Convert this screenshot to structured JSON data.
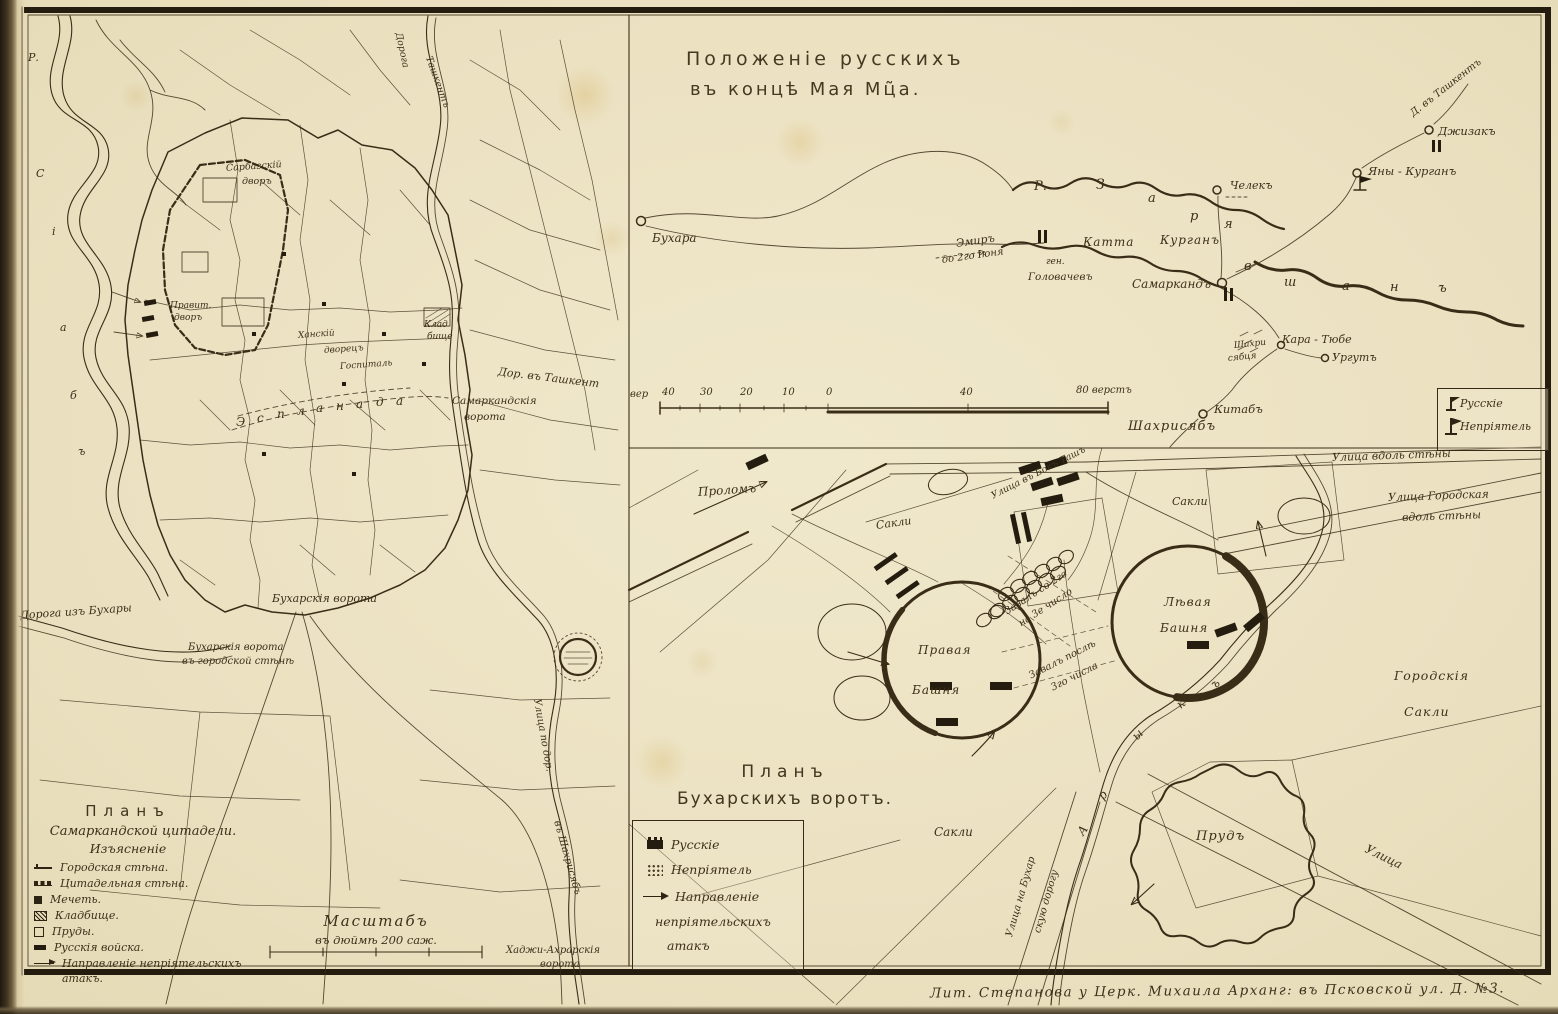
{
  "page": {
    "imprint": "Лит. Степанова   у Церк. Михаила   Арханг: въ Псковской ул. Д. №3."
  },
  "city_plan": {
    "legend": {
      "title": "Планъ",
      "subtitle": "Самаркандской цитадели.",
      "heading": "Изъясненіе",
      "items": [
        {
          "symbol": "city-wall",
          "label": "Городская стѣна."
        },
        {
          "symbol": "citadel-wall",
          "label": "Цитадельная стѣна."
        },
        {
          "symbol": "mosque",
          "label": "Мечеть."
        },
        {
          "symbol": "cemetery",
          "label": "Кладбище."
        },
        {
          "symbol": "pond",
          "label": "Пруды."
        },
        {
          "symbol": "russian-troops",
          "label": "Русскія войска."
        },
        {
          "symbol": "attack-direction",
          "label": "Направленіе непріятельскихъ"
        },
        {
          "symbol": "none",
          "label": "атакъ."
        }
      ]
    },
    "scale": {
      "title": "Масштабъ",
      "subtitle": "въ дюймѣ 200 саж."
    },
    "labels": [
      {
        "t": "Дорога",
        "x": 398,
        "y": 28,
        "r": 78,
        "s": 9.5
      },
      {
        "t": "Ташкентъ",
        "x": 428,
        "y": 52,
        "r": 70,
        "s": 9.5
      },
      {
        "t": "Сарбазскій",
        "x": 226,
        "y": 164,
        "r": -4,
        "s": 9.5
      },
      {
        "t": "дворъ",
        "x": 242,
        "y": 177,
        "s": 9.5
      },
      {
        "t": "Правит.",
        "x": 170,
        "y": 302,
        "s": 9
      },
      {
        "t": "дворъ",
        "x": 174,
        "y": 314,
        "s": 9
      },
      {
        "t": "Ханскій",
        "x": 298,
        "y": 332,
        "r": -4,
        "s": 9
      },
      {
        "t": "дворецъ",
        "x": 324,
        "y": 347,
        "r": -4,
        "s": 9
      },
      {
        "t": "Госпиталь",
        "x": 340,
        "y": 363,
        "r": -4,
        "s": 9
      },
      {
        "t": "Клад",
        "x": 424,
        "y": 321,
        "s": 9
      },
      {
        "t": "бище",
        "x": 427,
        "y": 333,
        "s": 9
      },
      {
        "t": "Дор. въ Ташкент",
        "x": 498,
        "y": 366,
        "r": 7,
        "s": 11
      },
      {
        "t": "Самаркандскія",
        "x": 452,
        "y": 396,
        "s": 10.5
      },
      {
        "t": "ворота",
        "x": 464,
        "y": 412,
        "s": 10.5
      },
      {
        "t": "Бухарскія ворота",
        "x": 272,
        "y": 593,
        "s": 11
      },
      {
        "t": "Бухарскія ворота",
        "x": 188,
        "y": 643,
        "s": 10
      },
      {
        "t": "въ городской стѣнѣ",
        "x": 182,
        "y": 657,
        "s": 10
      },
      {
        "t": "Дорога изъ Бухары",
        "x": 20,
        "y": 610,
        "r": -4,
        "s": 11
      },
      {
        "t": "Улица по дор.",
        "x": 536,
        "y": 694,
        "r": 80,
        "s": 10
      },
      {
        "t": "въ Шахрисябъ",
        "x": 556,
        "y": 816,
        "r": 74,
        "s": 10
      },
      {
        "t": "Хаджи-Ахрарскія",
        "x": 506,
        "y": 946,
        "s": 10
      },
      {
        "t": "ворота",
        "x": 540,
        "y": 960,
        "s": 10
      },
      {
        "t": "Р.",
        "x": 28,
        "y": 52,
        "s": 11
      },
      {
        "t": "С",
        "x": 36,
        "y": 168,
        "s": 11
      },
      {
        "t": "і",
        "x": 52,
        "y": 226,
        "s": 11
      },
      {
        "t": "а",
        "x": 60,
        "y": 322,
        "s": 11
      },
      {
        "t": "б",
        "x": 70,
        "y": 390,
        "s": 11
      },
      {
        "t": "ъ",
        "x": 78,
        "y": 446,
        "s": 11
      },
      {
        "t": "Э",
        "x": 236,
        "y": 416,
        "s": 12
      },
      {
        "t": "с",
        "x": 257,
        "y": 412,
        "s": 12
      },
      {
        "t": "п",
        "x": 277,
        "y": 408,
        "s": 12
      },
      {
        "t": "л",
        "x": 297,
        "y": 405,
        "s": 12
      },
      {
        "t": "а",
        "x": 316,
        "y": 402,
        "s": 12
      },
      {
        "t": "н",
        "x": 336,
        "y": 400,
        "s": 12
      },
      {
        "t": "а",
        "x": 356,
        "y": 398,
        "s": 12
      },
      {
        "t": "д",
        "x": 376,
        "y": 396,
        "s": 12
      },
      {
        "t": "а",
        "x": 396,
        "y": 395,
        "s": 12
      }
    ]
  },
  "overview_map": {
    "title_line1": "Положеніе русскихъ",
    "title_line2": "въ концѣ Мая Мц̃а.",
    "legend": {
      "items": [
        {
          "symbol": "russian-flag",
          "label": "Русскіе"
        },
        {
          "symbol": "enemy-flag",
          "label": "Непріятель"
        }
      ]
    },
    "labels": [
      {
        "t": "Бухара",
        "x": 652,
        "y": 232,
        "s": 12
      },
      {
        "t": "Эмиръ",
        "x": 956,
        "y": 238,
        "r": -8,
        "s": 11
      },
      {
        "t": "до 2го Іюня",
        "x": 942,
        "y": 256,
        "r": -8,
        "s": 10
      },
      {
        "t": "ген.",
        "x": 1046,
        "y": 258,
        "s": 9
      },
      {
        "t": "Головачевъ",
        "x": 1028,
        "y": 272,
        "s": 10.5
      },
      {
        "t": "Катта",
        "x": 1083,
        "y": 236,
        "s": 12,
        "ls": 1
      },
      {
        "t": "Курганъ",
        "x": 1160,
        "y": 234,
        "s": 12,
        "ls": 1
      },
      {
        "t": "Самаркандъ",
        "x": 1132,
        "y": 278,
        "s": 12
      },
      {
        "t": "Челекъ",
        "x": 1230,
        "y": 180,
        "s": 11
      },
      {
        "t": "Яны - Курганъ",
        "x": 1368,
        "y": 166,
        "s": 11.5
      },
      {
        "t": "Джизакъ",
        "x": 1438,
        "y": 126,
        "s": 11.5
      },
      {
        "t": "Д. въ Ташкентъ",
        "x": 1412,
        "y": 110,
        "r": -38,
        "s": 10
      },
      {
        "t": "Кара - Тюбе",
        "x": 1282,
        "y": 334,
        "s": 11
      },
      {
        "t": "Ургутъ",
        "x": 1332,
        "y": 352,
        "s": 11
      },
      {
        "t": "Шахри",
        "x": 1234,
        "y": 342,
        "r": -6,
        "s": 9
      },
      {
        "t": "сябця",
        "x": 1228,
        "y": 355,
        "r": -6,
        "s": 9
      },
      {
        "t": "Китабъ",
        "x": 1214,
        "y": 404,
        "s": 11.5
      },
      {
        "t": "Шахрисябъ",
        "x": 1128,
        "y": 420,
        "s": 13,
        "ls": 1
      },
      {
        "t": "Р.",
        "x": 1034,
        "y": 180,
        "s": 13
      },
      {
        "t": "З",
        "x": 1096,
        "y": 178,
        "s": 14
      },
      {
        "t": "а",
        "x": 1148,
        "y": 192,
        "s": 13
      },
      {
        "t": "р",
        "x": 1190,
        "y": 210,
        "s": 13
      },
      {
        "t": "я",
        "x": 1224,
        "y": 218,
        "s": 13
      },
      {
        "t": "в",
        "x": 1244,
        "y": 260,
        "s": 13
      },
      {
        "t": "ш",
        "x": 1284,
        "y": 276,
        "s": 13
      },
      {
        "t": "а",
        "x": 1342,
        "y": 280,
        "s": 13
      },
      {
        "t": "н",
        "x": 1390,
        "y": 281,
        "s": 13
      },
      {
        "t": "ъ",
        "x": 1438,
        "y": 282,
        "s": 13
      },
      {
        "t": "вер",
        "x": 630,
        "y": 390,
        "s": 10
      },
      {
        "t": "40",
        "x": 662,
        "y": 388,
        "s": 10
      },
      {
        "t": "30",
        "x": 700,
        "y": 388,
        "s": 10
      },
      {
        "t": "20",
        "x": 740,
        "y": 388,
        "s": 10
      },
      {
        "t": "10",
        "x": 782,
        "y": 388,
        "s": 10
      },
      {
        "t": "0",
        "x": 826,
        "y": 388,
        "s": 10
      },
      {
        "t": "40",
        "x": 960,
        "y": 388,
        "s": 10
      },
      {
        "t": "80 верстъ",
        "x": 1076,
        "y": 386,
        "s": 10
      }
    ]
  },
  "gate_plan": {
    "title_line1": "Планъ",
    "title_line2": "Бухарскихъ воротъ.",
    "legend": {
      "items": [
        {
          "symbol": "russian-block",
          "label": "Русскіе"
        },
        {
          "symbol": "enemy-dots",
          "label": "Непріятель"
        },
        {
          "symbol": "attack-arrow",
          "label": "Направленіе"
        },
        {
          "symbol": "none",
          "label": "непріятельскихъ"
        },
        {
          "symbol": "none",
          "label": "атакъ"
        }
      ]
    },
    "labels": [
      {
        "t": "Проломъ",
        "x": 698,
        "y": 486,
        "r": -4,
        "s": 12
      },
      {
        "t": "Улица въ Бокъ Ташъ",
        "x": 992,
        "y": 492,
        "r": -27,
        "s": 9.5
      },
      {
        "t": "Сакли",
        "x": 876,
        "y": 520,
        "r": -8,
        "s": 11
      },
      {
        "t": "Сакли",
        "x": 1172,
        "y": 496,
        "s": 11
      },
      {
        "t": "Улица вдоль стѣны",
        "x": 1332,
        "y": 452,
        "r": -2,
        "s": 11
      },
      {
        "t": "Улица Городская",
        "x": 1388,
        "y": 492,
        "r": -2,
        "s": 11
      },
      {
        "t": "вдоль стѣны",
        "x": 1402,
        "y": 512,
        "r": -2,
        "s": 11
      },
      {
        "t": "Завалъ со 2го",
        "x": 1006,
        "y": 608,
        "r": -33,
        "s": 10
      },
      {
        "t": "на 3е число",
        "x": 1020,
        "y": 620,
        "r": -33,
        "s": 10
      },
      {
        "t": "Правая",
        "x": 918,
        "y": 644,
        "s": 12,
        "ls": 1
      },
      {
        "t": "Башня",
        "x": 912,
        "y": 684,
        "s": 12,
        "ls": 1
      },
      {
        "t": "Лѣвая",
        "x": 1164,
        "y": 596,
        "s": 12,
        "ls": 1
      },
      {
        "t": "Башня",
        "x": 1160,
        "y": 622,
        "s": 12,
        "ls": 1
      },
      {
        "t": "Завалъ послѣ",
        "x": 1030,
        "y": 672,
        "r": -27,
        "s": 10
      },
      {
        "t": "3го числа",
        "x": 1052,
        "y": 684,
        "r": -27,
        "s": 10
      },
      {
        "t": "А",
        "x": 1080,
        "y": 828,
        "r": -55,
        "s": 12
      },
      {
        "t": "р",
        "x": 1100,
        "y": 792,
        "r": -50,
        "s": 12
      },
      {
        "t": "ы",
        "x": 1134,
        "y": 732,
        "r": -45,
        "s": 12
      },
      {
        "t": "к",
        "x": 1178,
        "y": 700,
        "r": -40,
        "s": 12
      },
      {
        "t": "ъ",
        "x": 1212,
        "y": 680,
        "r": -35,
        "s": 12
      },
      {
        "t": "Городскія",
        "x": 1394,
        "y": 670,
        "s": 12.5,
        "ls": 1
      },
      {
        "t": "Сакли",
        "x": 1404,
        "y": 706,
        "s": 12.5,
        "ls": 1
      },
      {
        "t": "Прудъ",
        "x": 1196,
        "y": 830,
        "s": 13,
        "ls": 1,
        "c": "onpond"
      },
      {
        "t": "Улица",
        "x": 1366,
        "y": 842,
        "r": 26,
        "s": 12
      },
      {
        "t": "Улица на Бухар",
        "x": 1010,
        "y": 932,
        "r": -74,
        "s": 10
      },
      {
        "t": "скую дорогу",
        "x": 1038,
        "y": 928,
        "r": -74,
        "s": 10
      },
      {
        "t": "Сакли",
        "x": 934,
        "y": 826,
        "s": 12
      }
    ]
  }
}
